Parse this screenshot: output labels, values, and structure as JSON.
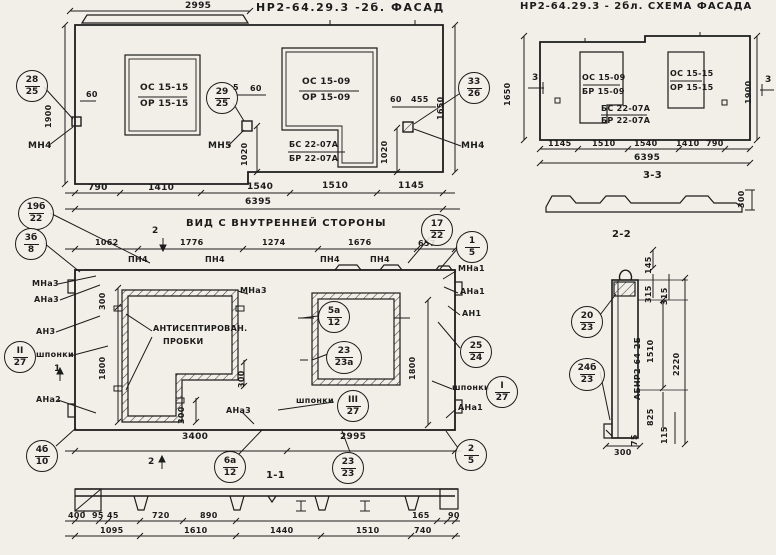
{
  "f": {
    "title": "НР2-64.29.3 -2б. ФАСАД",
    "cap": "2995",
    "w1": [
      "ОС 15-15",
      "ОР 15-15"
    ],
    "w2": [
      "ОС 15-09",
      "ОР 15-09"
    ],
    "w3": [
      "БС 22-07А",
      "БР 22-07А"
    ],
    "mn": [
      "МН4",
      "МН5",
      "МН4"
    ],
    "c1": [
      "28",
      "25"
    ],
    "c2": [
      "29",
      "25"
    ],
    "c3": [
      "33",
      "26"
    ],
    "d": {
      "l60": "60",
      "m5": "5",
      "m60": "60",
      "r60": "60",
      "r455": "455",
      "v1020a": "1020",
      "v1020b": "1020",
      "v1900": "1900",
      "v1650": "1650",
      "total": "6395"
    },
    "db": [
      "790",
      "1410",
      "1540",
      "1510",
      "1145"
    ]
  },
  "s": {
    "title": "НР2-64.29.3 - 2бл. СХЕМА ФАСАДА",
    "w1": [
      "ОС 15-09",
      "БР 15-09"
    ],
    "w2": [
      "ОС 15-15",
      "ОР 15-15"
    ],
    "w3": [
      "БС 22-07А",
      "БР 22-07А"
    ],
    "m3": "3",
    "d": {
      "v1650": "1650",
      "v1900": "1900",
      "total": "6395",
      "p300": "300"
    },
    "db": [
      "1145",
      "1510",
      "1540",
      "1410",
      "790"
    ],
    "s33": "3-3"
  },
  "v": {
    "title": "ВИД С ВНУТРЕННЕЙ СТОРОНЫ",
    "dt": [
      "1062",
      "1776",
      "1274",
      "1676",
      "657"
    ],
    "pn": "ПН4",
    "m1": "1",
    "m2": "2",
    "c19": [
      "19б",
      "22"
    ],
    "c3b": [
      "3б",
      "8"
    ],
    "c17": [
      "17",
      "22"
    ],
    "c15": [
      "1",
      "5"
    ],
    "l": {
      "mna3": "МНа3",
      "ana3": "АНа3",
      "an3": "АН3",
      "shp": "шпонки",
      "c27": [
        "II",
        "27"
      ],
      "ana2": "АНа2",
      "c410": [
        "4б",
        "10"
      ]
    },
    "r": {
      "mna1": "МНа1",
      "ana1": "АНа1",
      "an1": "АН1",
      "c2524": [
        "25",
        "24"
      ],
      "shp": "шпонки",
      "c127": [
        "I",
        "27"
      ],
      "ana1b": "АНа1"
    },
    "m": {
      "mna3": "МНа3",
      "plug1": "АНТИСЕПТИРОВАН.",
      "plug2": "ПРОБКИ",
      "ana3": "АНа3",
      "shp": "шпонки",
      "c327": [
        "III",
        "27"
      ]
    },
    "c5a": [
      "5а",
      "12"
    ],
    "c23a": [
      "23",
      "23а"
    ],
    "c6a": [
      "6а",
      "12"
    ],
    "c2323": [
      "23",
      "23"
    ],
    "c25": [
      "2",
      "5"
    ],
    "d": {
      "t300": "300",
      "l1800": "1800",
      "s300": "300",
      "b300": "300",
      "r1800": "1800",
      "b3400": "3400",
      "b2995": "2995"
    }
  },
  "p1": {
    "label": "1-1",
    "r1": [
      "400",
      "95",
      "45",
      "720",
      "890",
      "165",
      "90"
    ],
    "r2": [
      "1095",
      "1610",
      "1440",
      "1510",
      "740"
    ]
  },
  "p2": {
    "label": "2-2",
    "c20": [
      "20",
      "23"
    ],
    "c24": [
      "24б",
      "23"
    ],
    "mark": "АБНР2-64-2Б",
    "d": [
      "145",
      "315",
      "315",
      "1510",
      "2220",
      "825",
      "115",
      "75",
      "300"
    ]
  }
}
